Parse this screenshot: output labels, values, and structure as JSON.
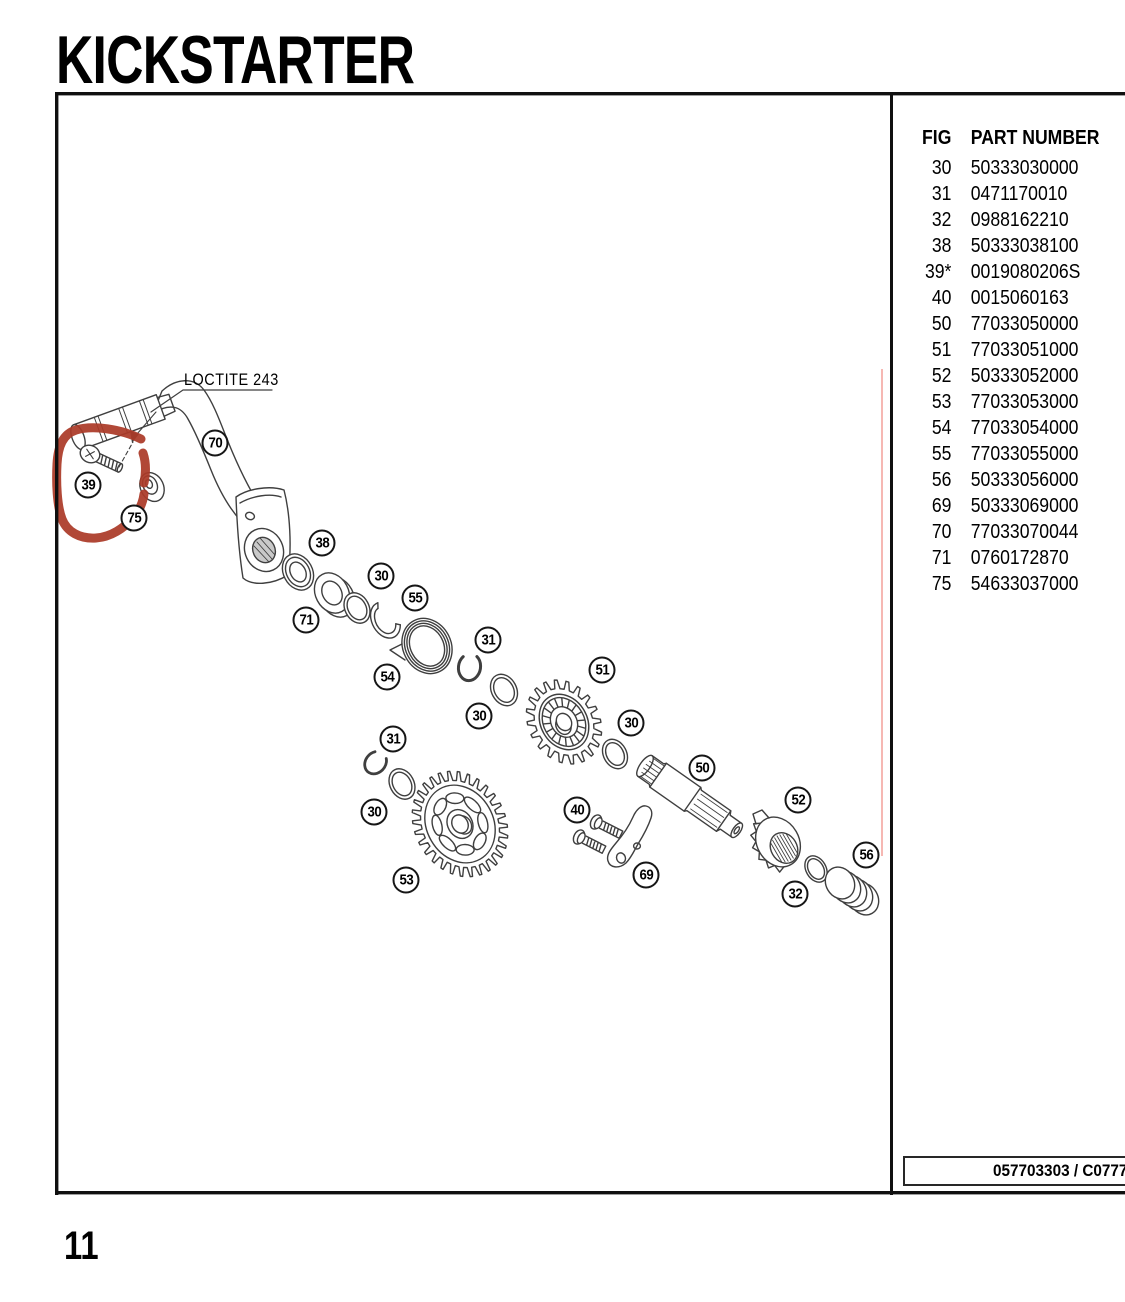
{
  "page": {
    "title": "KICKSTARTER",
    "page_number": "11"
  },
  "table": {
    "headers": {
      "fig": "FIG",
      "part": "PART NUMBER"
    },
    "rows": [
      {
        "fig": "30",
        "part": "50333030000"
      },
      {
        "fig": "31",
        "part": "0471170010"
      },
      {
        "fig": "32",
        "part": "0988162210"
      },
      {
        "fig": "38",
        "part": "50333038100"
      },
      {
        "fig": "39*",
        "part": "0019080206S"
      },
      {
        "fig": "40",
        "part": "0015060163"
      },
      {
        "fig": "50",
        "part": "77033050000"
      },
      {
        "fig": "51",
        "part": "77033051000"
      },
      {
        "fig": "52",
        "part": "50333052000"
      },
      {
        "fig": "53",
        "part": "77033053000"
      },
      {
        "fig": "54",
        "part": "77033054000"
      },
      {
        "fig": "55",
        "part": "77033055000"
      },
      {
        "fig": "56",
        "part": "50333056000"
      },
      {
        "fig": "69",
        "part": "50333069000"
      },
      {
        "fig": "70",
        "part": "77033070044"
      },
      {
        "fig": "71",
        "part": "0760172870"
      },
      {
        "fig": "75",
        "part": "54633037000"
      }
    ]
  },
  "plate": {
    "code": "057703303 / C0777"
  },
  "diagram": {
    "loctite_label": "LOCTITE 243",
    "annotation_color": "#ab3a28",
    "pink_line_color": "#f3a7a0",
    "line_color": "#3f3f3f",
    "callouts": [
      {
        "label": "70",
        "x": 215,
        "y": 443
      },
      {
        "label": "39",
        "x": 88,
        "y": 485
      },
      {
        "label": "75",
        "x": 134,
        "y": 518
      },
      {
        "label": "38",
        "x": 322,
        "y": 543
      },
      {
        "label": "30",
        "x": 381,
        "y": 576
      },
      {
        "label": "55",
        "x": 415,
        "y": 598
      },
      {
        "label": "71",
        "x": 306,
        "y": 620
      },
      {
        "label": "31",
        "x": 488,
        "y": 640
      },
      {
        "label": "54",
        "x": 387,
        "y": 677
      },
      {
        "label": "51",
        "x": 602,
        "y": 670
      },
      {
        "label": "30",
        "x": 479,
        "y": 716
      },
      {
        "label": "30",
        "x": 631,
        "y": 723
      },
      {
        "label": "31",
        "x": 393,
        "y": 739
      },
      {
        "label": "50",
        "x": 702,
        "y": 768
      },
      {
        "label": "52",
        "x": 798,
        "y": 800
      },
      {
        "label": "40",
        "x": 577,
        "y": 810
      },
      {
        "label": "30",
        "x": 374,
        "y": 812
      },
      {
        "label": "56",
        "x": 866,
        "y": 855
      },
      {
        "label": "69",
        "x": 646,
        "y": 875
      },
      {
        "label": "53",
        "x": 406,
        "y": 880
      },
      {
        "label": "32",
        "x": 795,
        "y": 894
      }
    ]
  }
}
